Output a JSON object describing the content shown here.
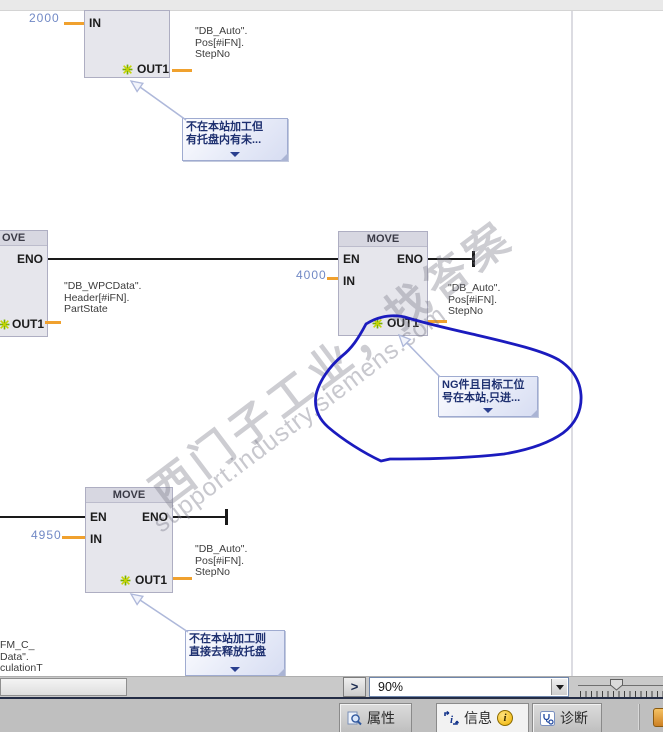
{
  "watermark": {
    "cn": "西门子工业，找答案",
    "en": "support.industry.siemens.com"
  },
  "diagram": {
    "b1": {
      "value_in": "2000",
      "pin_in": "IN",
      "pin_out": "OUT1",
      "operand": {
        "l1": "\"DB_Auto\".",
        "l2": "Pos[#iFN].",
        "l3": "StepNo"
      },
      "comment": {
        "l1": "不在本站加工但",
        "l2": "有托盘内有未..."
      }
    },
    "b2_partial": {
      "title": "OVE",
      "pin_eno": "ENO",
      "pin_out": "OUT1",
      "operand": {
        "l1": "\"DB_WPCData\".",
        "l2": "Header[#iFN].",
        "l3": "PartState"
      }
    },
    "b2": {
      "title": "MOVE",
      "pin_en": "EN",
      "pin_eno": "ENO",
      "pin_in": "IN",
      "value_in": "4000",
      "pin_out": "OUT1",
      "operand": {
        "l1": "\"DB_Auto\".",
        "l2": "Pos[#iFN].",
        "l3": "StepNo"
      },
      "comment": {
        "l1": "NG件且目标工位",
        "l2": "号在本站,只进..."
      }
    },
    "b3": {
      "title": "MOVE",
      "pin_en": "EN",
      "pin_eno": "ENO",
      "pin_in": "IN",
      "value_in": "4950",
      "pin_out": "OUT1",
      "operand": {
        "l1": "\"DB_Auto\".",
        "l2": "Pos[#iFN].",
        "l3": "StepNo"
      },
      "comment": {
        "l1": "不在本站加工则",
        "l2": "直接去释放托盘"
      },
      "partial_operand": {
        "l1": "FM_C_",
        "l2": "Data\".",
        "l3": "culationT"
      }
    }
  },
  "bottom_bar": {
    "expand": ">",
    "zoom": "90%"
  },
  "status_bar": {
    "tab_properties": "属性",
    "tab_info": "信息",
    "tab_diagnostics": "诊断",
    "info_badge": "i"
  },
  "colors": {
    "wire_orange": "#f0a12e",
    "value_blue": "#7189c5",
    "ink_blue": "#1b1bbe",
    "comment_text": "#1e3070",
    "badge_yellow": "#efb300"
  }
}
